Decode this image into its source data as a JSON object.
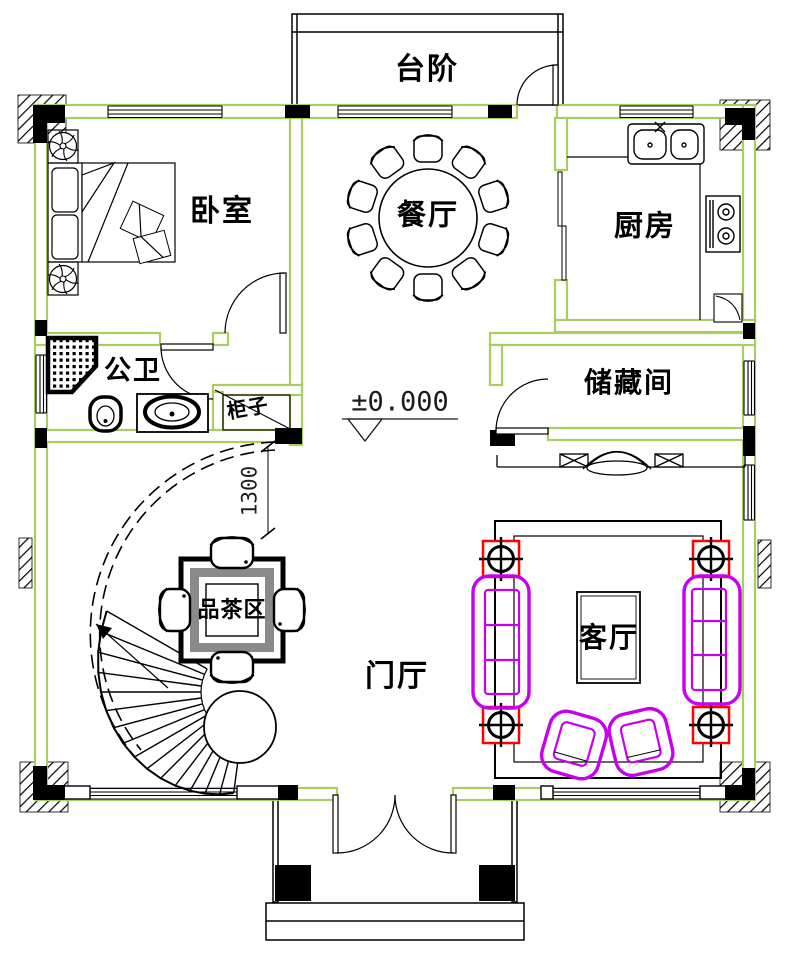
{
  "plan": {
    "rooms": {
      "steps": {
        "label": "台阶"
      },
      "bedroom": {
        "label": "卧室"
      },
      "dining": {
        "label": "餐厅"
      },
      "kitchen": {
        "label": "厨房"
      },
      "bathroom": {
        "label": "公卫"
      },
      "cabinet": {
        "label": "柜子"
      },
      "storage": {
        "label": "储藏间"
      },
      "tea_area": {
        "label": "品茶区"
      },
      "foyer": {
        "label": "门厅"
      },
      "living_room": {
        "label": "客厅"
      }
    },
    "annotations": {
      "elevation": "±0.000",
      "stair_dimension": "1300"
    },
    "colors": {
      "wall_outline": "#a9cd5e",
      "column_fill": "#000000",
      "sofa_outline": "#c800f0",
      "structural_post_outline": "#ff0000",
      "drawing_line": "#000000",
      "tea_table_band": "#8a8a8a"
    }
  }
}
